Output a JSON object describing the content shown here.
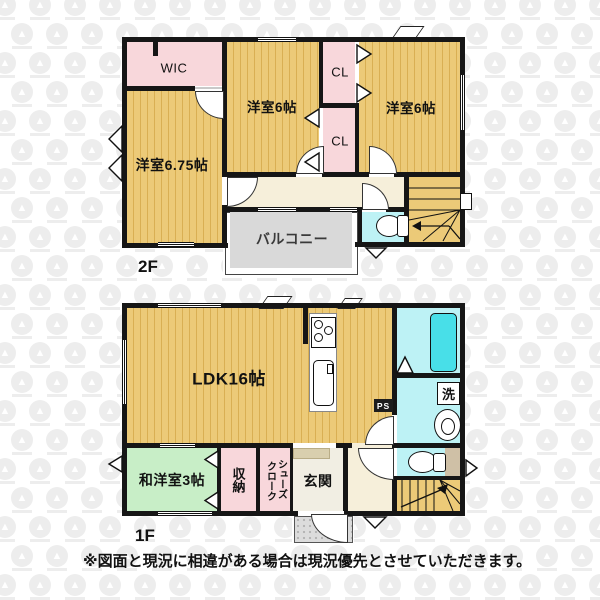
{
  "floor2": {
    "label": "2F",
    "wic": "WIC",
    "room675": "洋室6.75帖",
    "room6_mid": "洋室6帖",
    "room6_right": "洋室6帖",
    "cl_top": "CL",
    "cl_bottom": "CL",
    "balcony": "バルコニー"
  },
  "floor1": {
    "label": "1F",
    "ldk": "LDK16帖",
    "tatami_room": "和洋室3帖",
    "storage": "収納",
    "shoe_closet_col_right": "シューズ",
    "shoe_closet_col_left": "クローク",
    "entrance": "玄関",
    "laundry": "洗",
    "pipe_space": "PS"
  },
  "disclaimer": "※図面と現況に相違がある場合は現況優先とさせていただきます。",
  "colors": {
    "floor_tan": "#ecca78",
    "floor_stripe": "#d9af53",
    "closet_pink": "#f8d7db",
    "wet_room_cyan": "#bdf2f5",
    "bathtub_cyan": "#48dfe8",
    "tatami_green": "#c8eec7",
    "hall_cream": "#f6efda",
    "balcony_gray": "#d9d9d9",
    "wall": "#161616"
  }
}
